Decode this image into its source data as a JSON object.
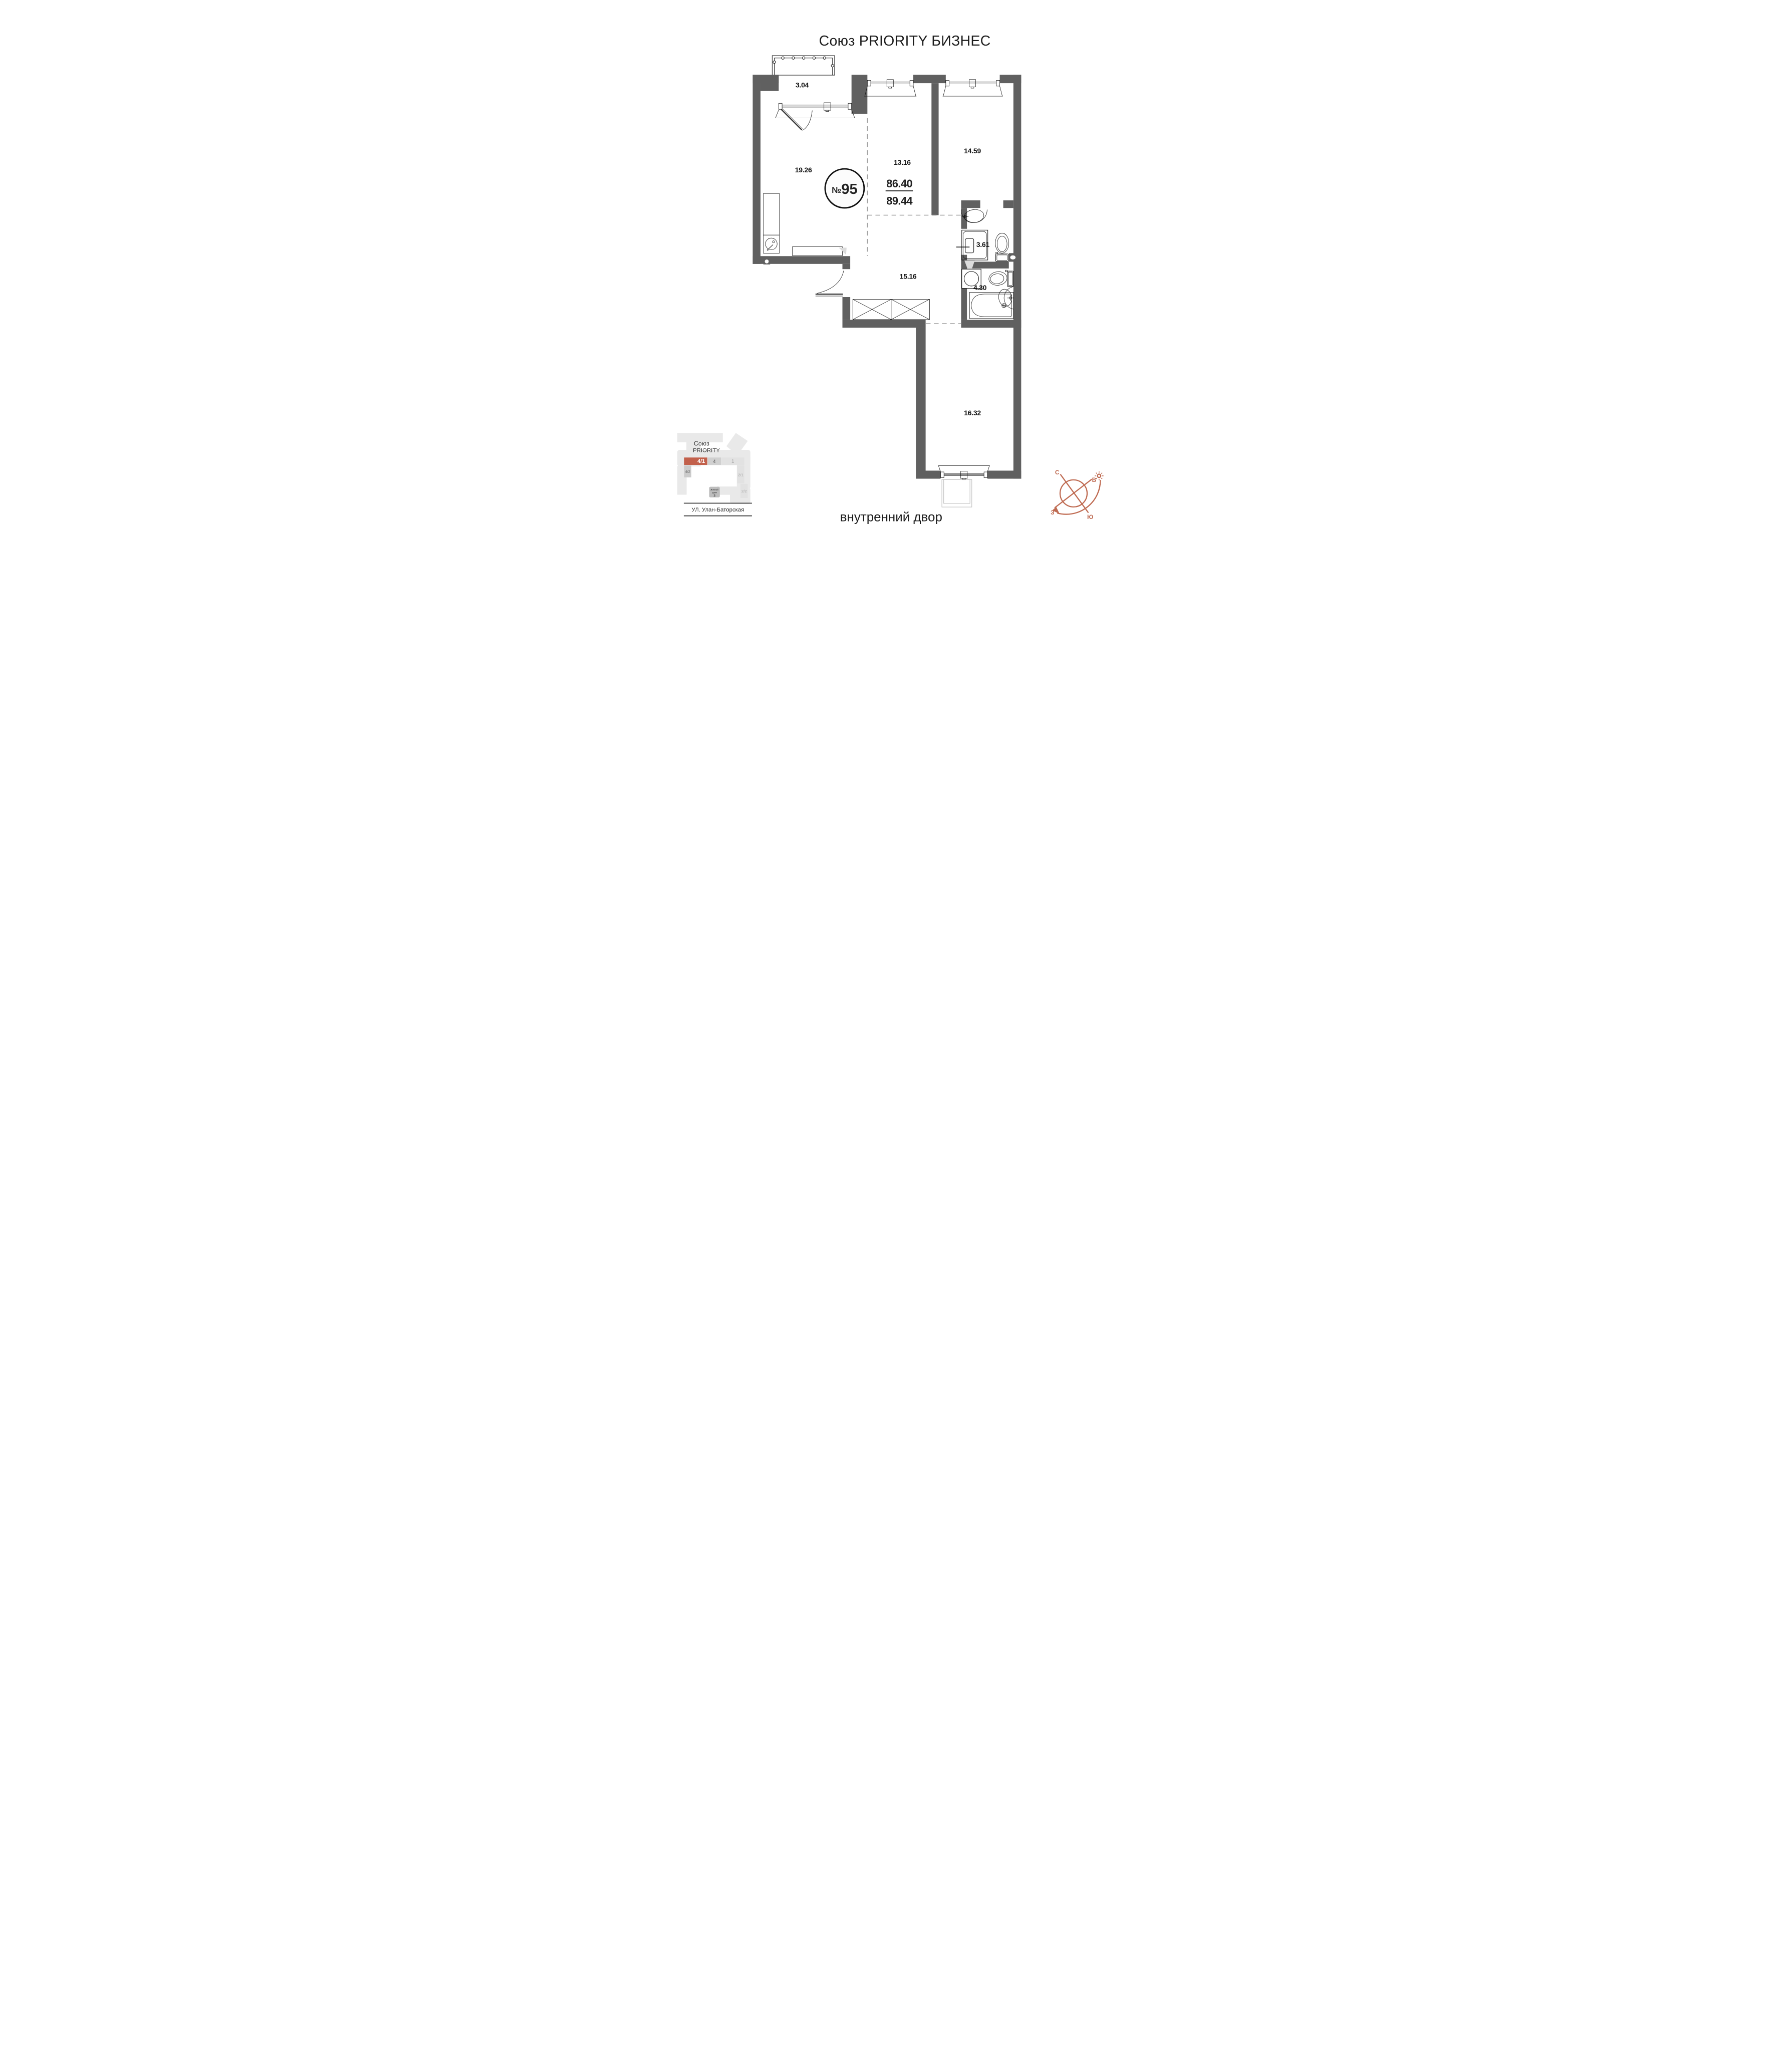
{
  "title": "Союз PRIORITY БИЗНЕС",
  "apartment": {
    "number_sign": "№",
    "number": "95",
    "area_main": "86.40",
    "area_total": "89.44"
  },
  "rooms": [
    {
      "id": "balcony-top",
      "area": "3.04"
    },
    {
      "id": "living-kitchen",
      "area": "19.26"
    },
    {
      "id": "bedroom-1",
      "area": "13.16"
    },
    {
      "id": "bedroom-2",
      "area": "14.59"
    },
    {
      "id": "hallway",
      "area": "15.16"
    },
    {
      "id": "bathroom-ensuite",
      "area": "3.61"
    },
    {
      "id": "bathroom",
      "area": "4.30"
    },
    {
      "id": "bedroom-3",
      "area": "16.32"
    }
  ],
  "minimap": {
    "project_line1": "Союз",
    "project_line2": "PRIORITY",
    "blocks": [
      {
        "label": "4/1",
        "highlighted": true
      },
      {
        "label": "4",
        "highlighted": false
      },
      {
        "label": "1",
        "highlighted": false
      },
      {
        "label": "4/2",
        "highlighted": false
      },
      {
        "label": "2/1",
        "highlighted": false
      },
      {
        "label": "2/2",
        "highlighted": false
      }
    ],
    "house_line1": "Жилой",
    "house_line2": "дом",
    "house_number": "3",
    "street": "УЛ. Улан-Баторская"
  },
  "courtyard_label": "внутренний двор",
  "compass": {
    "north": "С",
    "east": "В",
    "south": "Ю",
    "west": "З"
  },
  "colors": {
    "wall": "#606060",
    "accent": "#c2604b",
    "compass": "#bf6b52"
  }
}
